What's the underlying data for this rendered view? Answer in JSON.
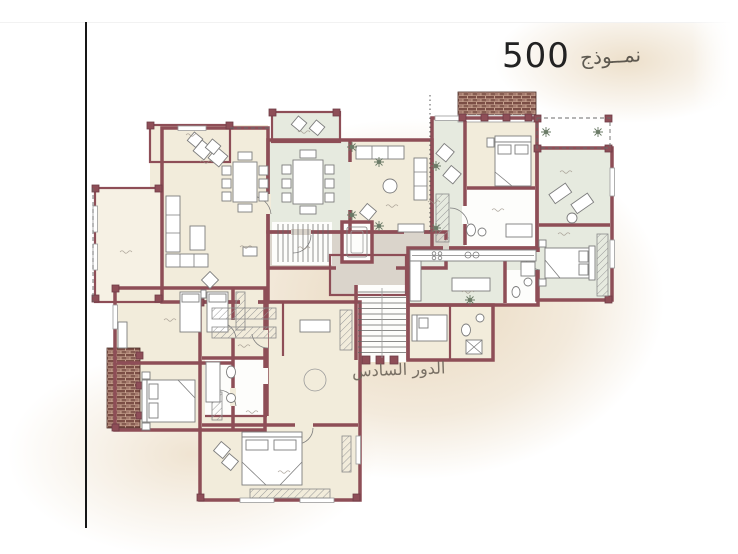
{
  "title": {
    "model_word": "نمــوذج",
    "model_number": "500"
  },
  "floor_label": "الدور السادس",
  "palette": {
    "wall": "#8e4e57",
    "wall_dark": "#6f3d46",
    "room_cream": "#f2ecdb",
    "room_cream_light": "#f6f1e4",
    "room_green": "#e6eadf",
    "corridor_gray": "#dad4cb",
    "room_white": "#fdfdfb",
    "brick_dark": "#6d4038",
    "brick_mid": "#a47a6d",
    "brick_light": "#c7a28f",
    "paper_beige": "#e7d5b9",
    "ink": "#222222",
    "pencil": "#6f675c",
    "furniture_line": "#7d7d7d"
  }
}
